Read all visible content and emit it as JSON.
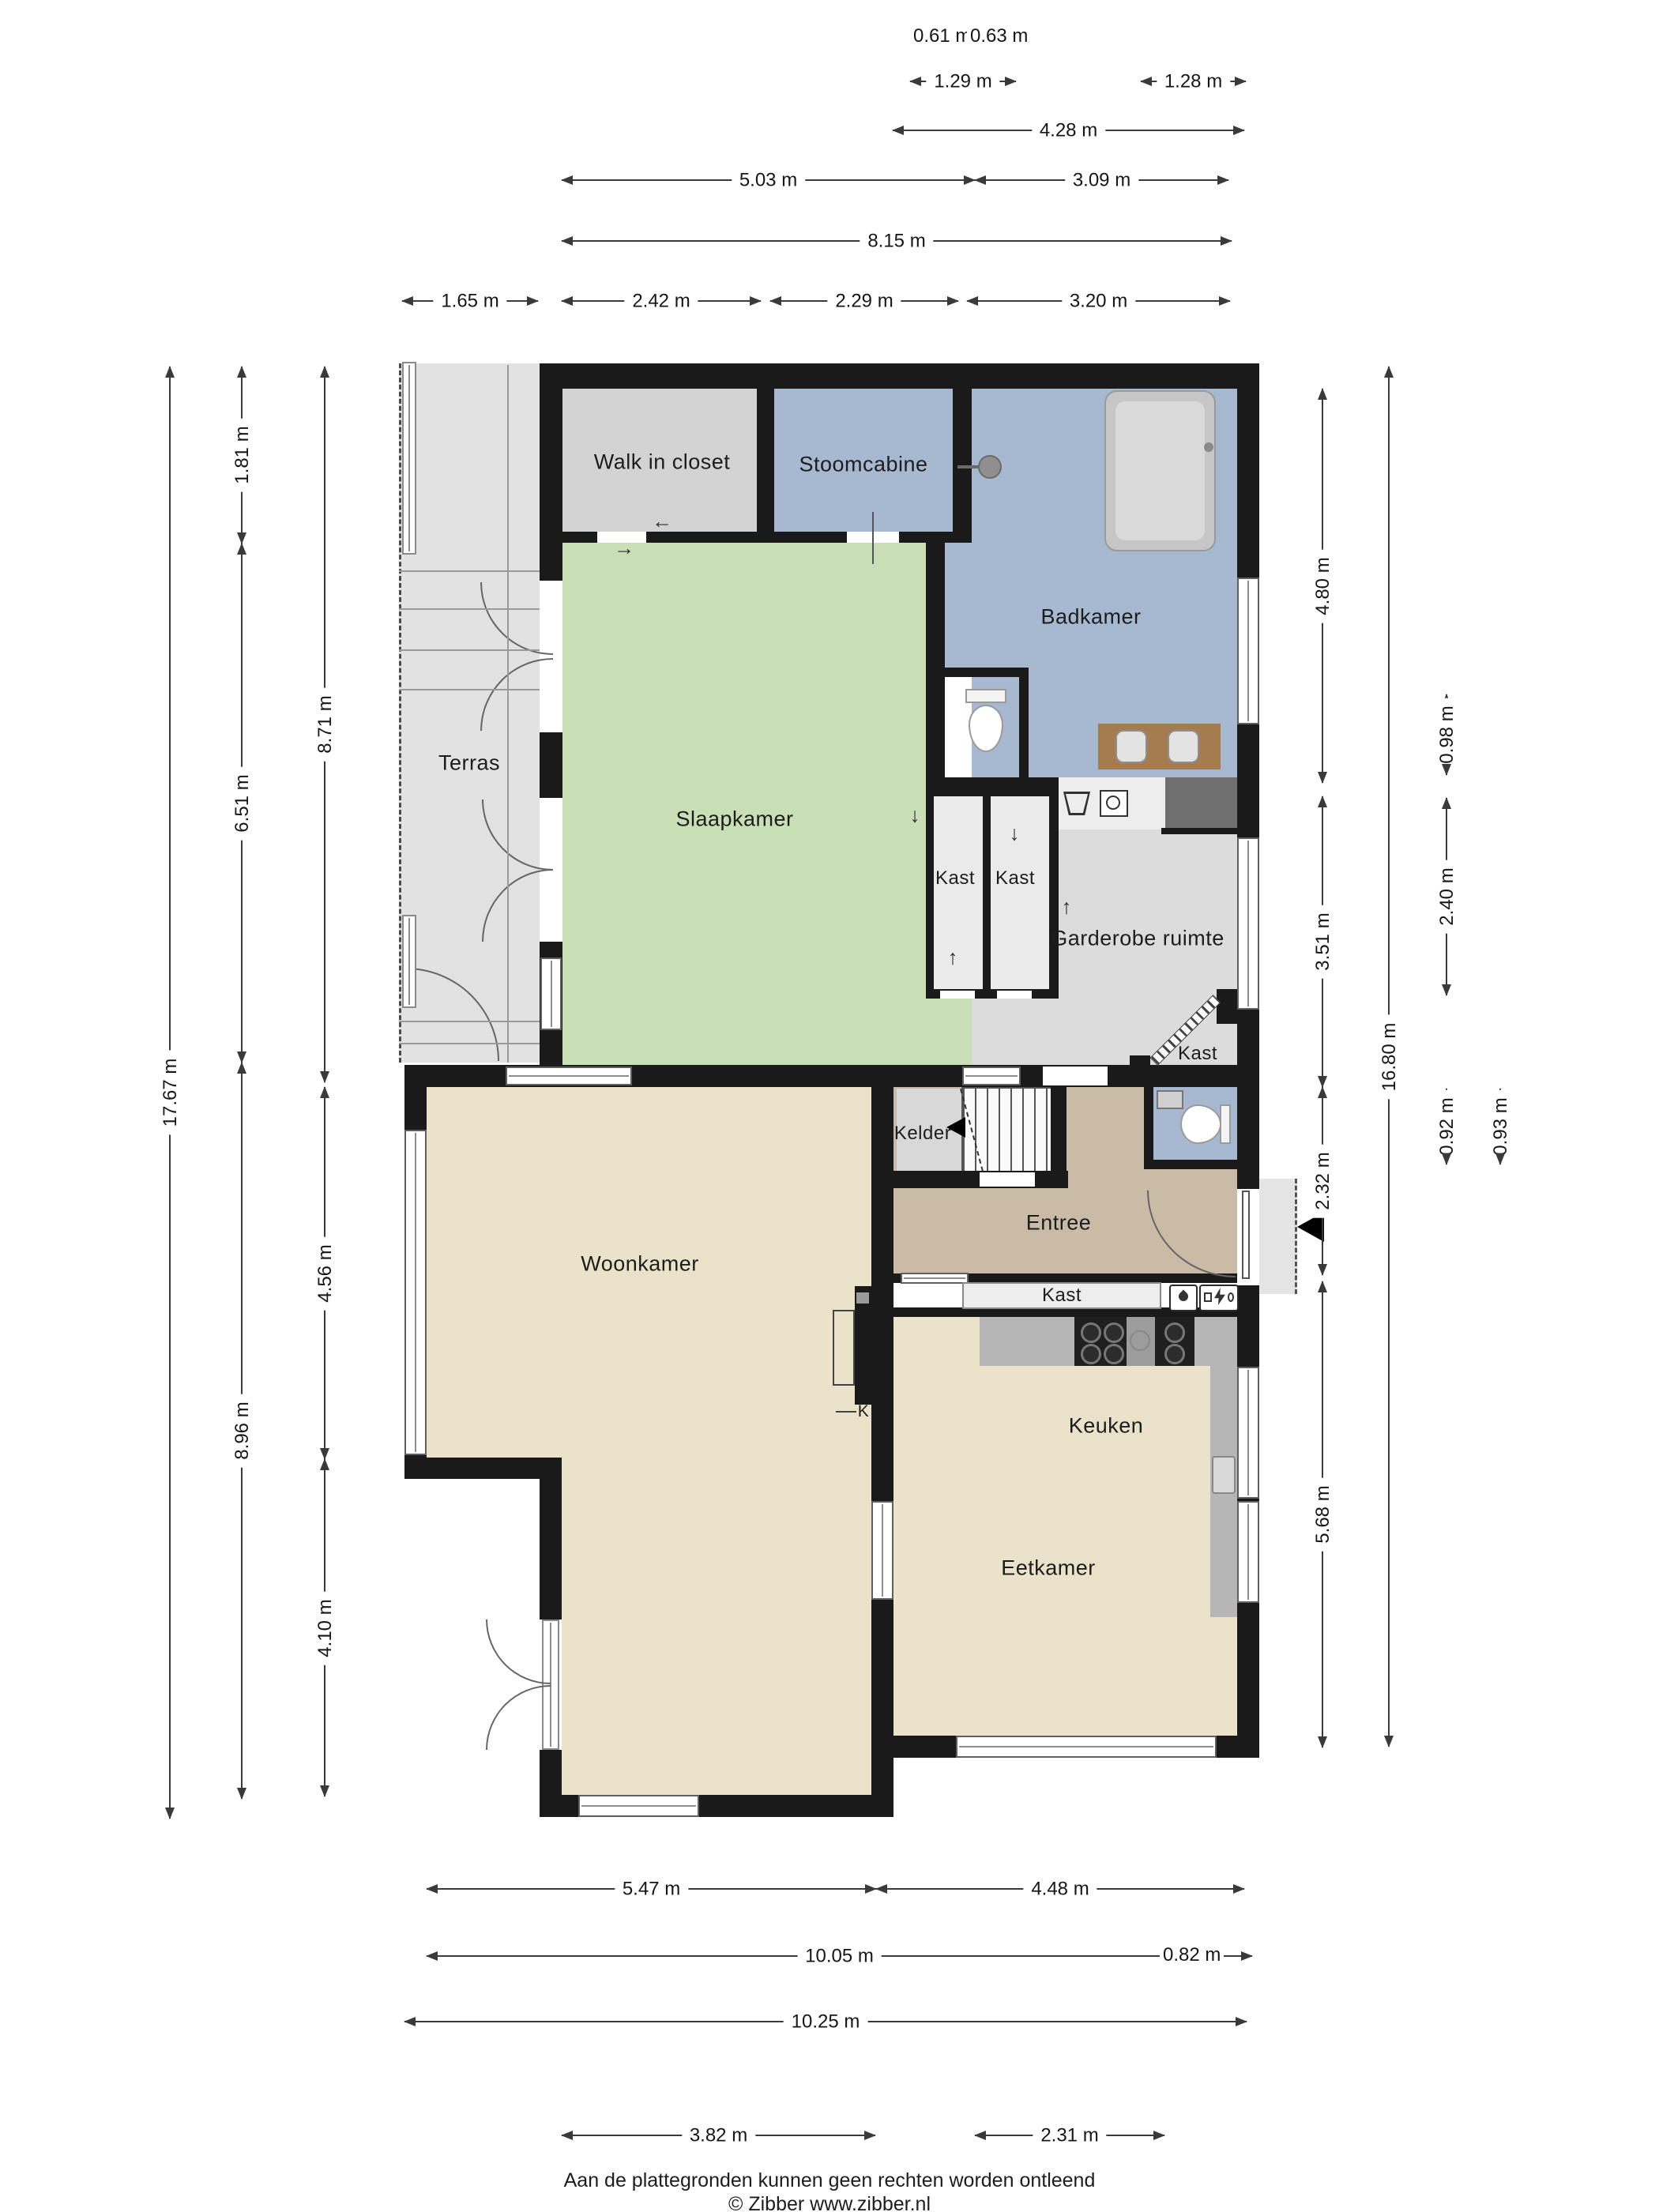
{
  "document": {
    "type": "floor-plan",
    "language": "nl",
    "footer": {
      "line1": "Aan de plattegronden kunnen geen rechten worden ontleend",
      "line2": "© Zibber www.zibber.nl"
    }
  },
  "rooms": {
    "terras": "Terras",
    "walk_in_closet": "Walk in closet",
    "stoomcabine": "Stoomcabine",
    "badkamer": "Badkamer",
    "slaapkamer": "Slaapkamer",
    "kast_a": "Kast",
    "kast_b": "Kast",
    "garderobe": "Garderobe ruimte",
    "kast_c": "Kast",
    "kelder": "Kelder",
    "entree": "Entree",
    "kast_d": "Kast",
    "woonkamer": "Woonkamer",
    "keuken": "Keuken",
    "eetkamer": "Eetkamer",
    "fireplace": "K"
  },
  "dimensions": {
    "top": [
      {
        "label": "0.61 m"
      },
      {
        "label": "0.63 m"
      },
      {
        "label": "1.29 m"
      },
      {
        "label": "1.28 m"
      },
      {
        "label": "4.28 m"
      },
      {
        "label": "5.03 m"
      },
      {
        "label": "3.09 m"
      },
      {
        "label": "8.15 m"
      },
      {
        "label": "1.65 m"
      },
      {
        "label": "2.42 m"
      },
      {
        "label": "2.29 m"
      },
      {
        "label": "3.20 m"
      }
    ],
    "left": [
      {
        "label": "17.67 m"
      },
      {
        "label": "1.81 m"
      },
      {
        "label": "6.51 m"
      },
      {
        "label": "8.96 m"
      },
      {
        "label": "8.71 m"
      },
      {
        "label": "4.56 m"
      },
      {
        "label": "4.10 m"
      }
    ],
    "right": [
      {
        "label": "4.80 m"
      },
      {
        "label": "3.51 m"
      },
      {
        "label": "2.32 m"
      },
      {
        "label": "5.68 m"
      },
      {
        "label": "16.80 m"
      },
      {
        "label": "0.98 m"
      },
      {
        "label": "2.40 m"
      },
      {
        "label": "0.92 m"
      },
      {
        "label": "0.93 m"
      }
    ],
    "bottom": [
      {
        "label": "5.47 m"
      },
      {
        "label": "4.48 m"
      },
      {
        "label": "10.05 m"
      },
      {
        "label": "0.82 m"
      },
      {
        "label": "10.25 m"
      },
      {
        "label": "3.82 m"
      },
      {
        "label": "2.31 m"
      }
    ]
  },
  "icons": {
    "arrow_up": "↑",
    "arrow_down": "↓",
    "arrow_left": "←",
    "arrow_right": "→"
  },
  "colors": {
    "wall": "#1a1a1a",
    "wet_room_blue": "#a7b8d1",
    "bedroom_green": "#c9dfb5",
    "living_tan": "#eae2c9",
    "entry_tan": "#c9bba6",
    "terrace_gray": "#e2e2e2",
    "closet_gray": "#d3d3d3",
    "vanity_brown": "#a57c50"
  }
}
